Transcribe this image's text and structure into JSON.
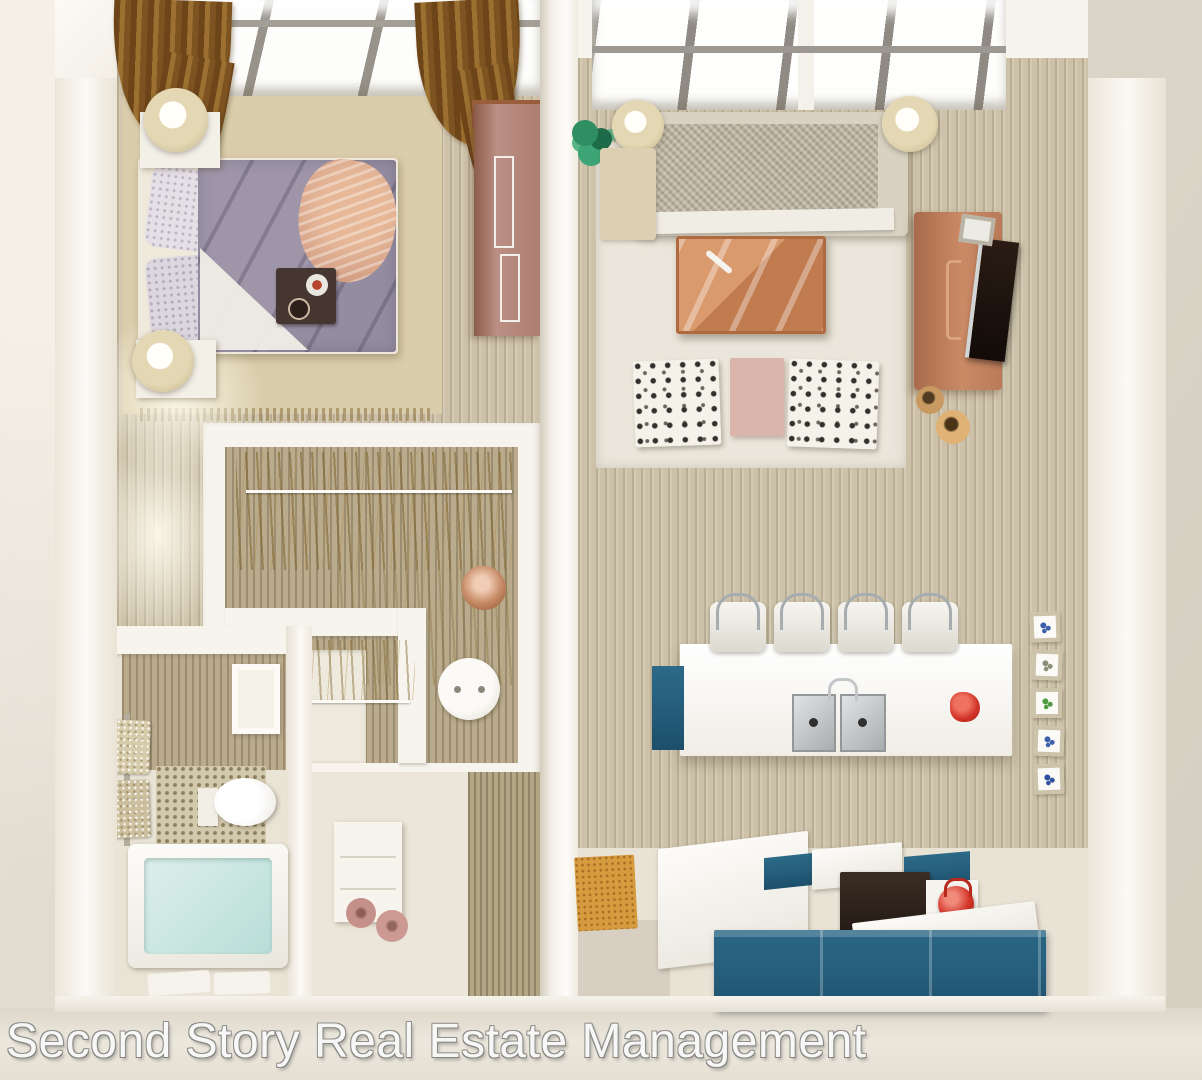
{
  "watermark": {
    "text": "Second Story Real Estate Management"
  },
  "scene": {
    "type": "3d-top-down-floor-plan-rendering",
    "units": [
      {
        "name": "left-unit",
        "rooms": [
          "bedroom",
          "walk-in-closet",
          "bathroom",
          "entry-hall"
        ]
      },
      {
        "name": "right-unit",
        "rooms": [
          "living-room",
          "kitchen"
        ]
      }
    ],
    "furniture": {
      "bedroom": [
        "skylight-windows",
        "brown-curtains",
        "double-bed",
        "patterned-quilt",
        "peach-throw",
        "pillows",
        "breakfast-tray",
        "nightstand-top",
        "nightstand-bottom",
        "table-lamp-top",
        "table-lamp-bottom",
        "wardrobe",
        "area-rug",
        "wall-art"
      ],
      "walk-in-closet": [
        "hanging-rod-top",
        "hanging-rod-low",
        "hanging-clothes",
        "partition-walls",
        "round-side-table",
        "copper-decor-ball"
      ],
      "bathroom": [
        "mirror",
        "towel-rack",
        "towels",
        "toilet",
        "mosaic-shower-floor",
        "bathtub",
        "bath-mats"
      ],
      "entry-hall": [
        "vanity-cabinet",
        "rolled-towels",
        "wood-panel-wall"
      ],
      "living-room": [
        "skylight-windows",
        "potted-plant",
        "sofa",
        "floor-lamp-left",
        "floor-lamp-right",
        "side-table",
        "copper-coffee-table",
        "tv-console",
        "television",
        "decor-vases",
        "patterned-cube-chair-left",
        "patterned-cube-chair-right",
        "pink-side-table",
        "area-rug"
      ],
      "kitchen": [
        "island-counter",
        "bar-stools",
        "double-sink",
        "faucet",
        "red-decor-bowl",
        "wall-tile-art",
        "kitchen-counters",
        "teal-cabinets",
        "oven",
        "red-kettle",
        "door-mat"
      ]
    }
  },
  "colors": {
    "wood": "#cdc2a9",
    "rug": "#dacdab",
    "curtain": "#9c7030",
    "quilt": "#9e96a8",
    "quilt_accent": "#d8a58a",
    "wardrobe": "#bb8f85",
    "sofa": "#b5ad99",
    "copper": "#c07b4e",
    "teal": "#265f7d",
    "teal_dark": "#1c4f6a",
    "red": "#d23327",
    "water": "#cbe7e2",
    "plant": "#2f8e62",
    "mat": "#d79b3f",
    "watermark_outline": "#8f8f8b"
  }
}
